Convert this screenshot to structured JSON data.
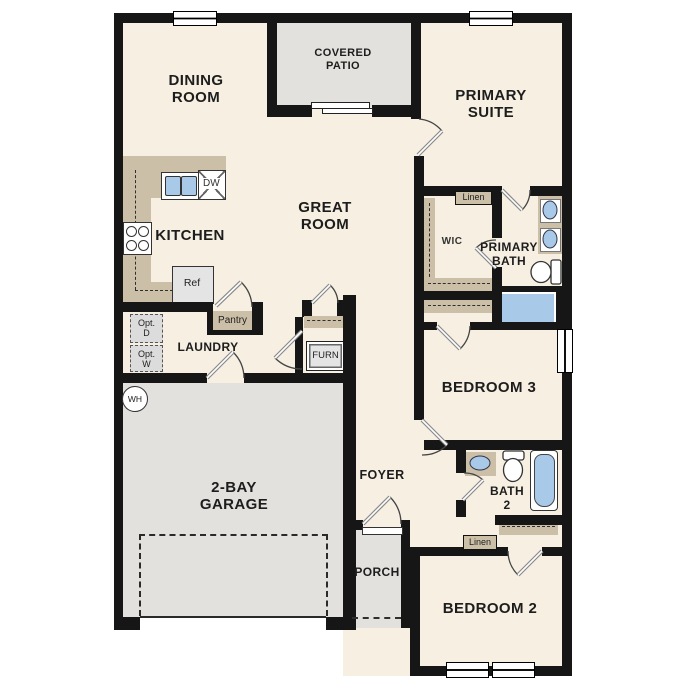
{
  "plan": {
    "name": "single-story floor plan",
    "colors": {
      "wall": "#161616",
      "floor_beige": "#f6efe2",
      "exterior_gray": "#e2e1de",
      "casework_tan": "#cbbfa7",
      "appliance_gray": "#e4e4e4",
      "fixture_blue": "#a9c9e9"
    },
    "rooms": {
      "dining": {
        "l1": "DINING",
        "l2": "ROOM"
      },
      "covered_patio": {
        "l1": "COVERED",
        "l2": "PATIO"
      },
      "primary_suite": {
        "l1": "PRIMARY",
        "l2": "SUITE"
      },
      "great_room": {
        "l1": "GREAT",
        "l2": "ROOM"
      },
      "kitchen": {
        "label": "KITCHEN"
      },
      "wic": {
        "label": "WIC"
      },
      "primary_bath": {
        "l1": "PRIMARY",
        "l2": "BATH"
      },
      "laundry": {
        "label": "LAUNDRY"
      },
      "garage": {
        "l1": "2-BAY",
        "l2": "GARAGE"
      },
      "foyer": {
        "label": "FOYER"
      },
      "bedroom3": {
        "label": "BEDROOM 3"
      },
      "bath2": {
        "l1": "BATH",
        "l2": "2"
      },
      "porch": {
        "label": "PORCH"
      },
      "bedroom2": {
        "label": "BEDROOM 2"
      }
    },
    "fixtures": {
      "pantry": "Pantry",
      "linen_primary": "Linen",
      "linen_hall": "Linen",
      "refrigerator": "Ref",
      "dishwasher": "DW",
      "furnace": "FURN",
      "water_heater": "WH",
      "opt_dryer": {
        "l1": "Opt.",
        "l2": "D"
      },
      "opt_washer": {
        "l1": "Opt.",
        "l2": "W"
      }
    }
  }
}
